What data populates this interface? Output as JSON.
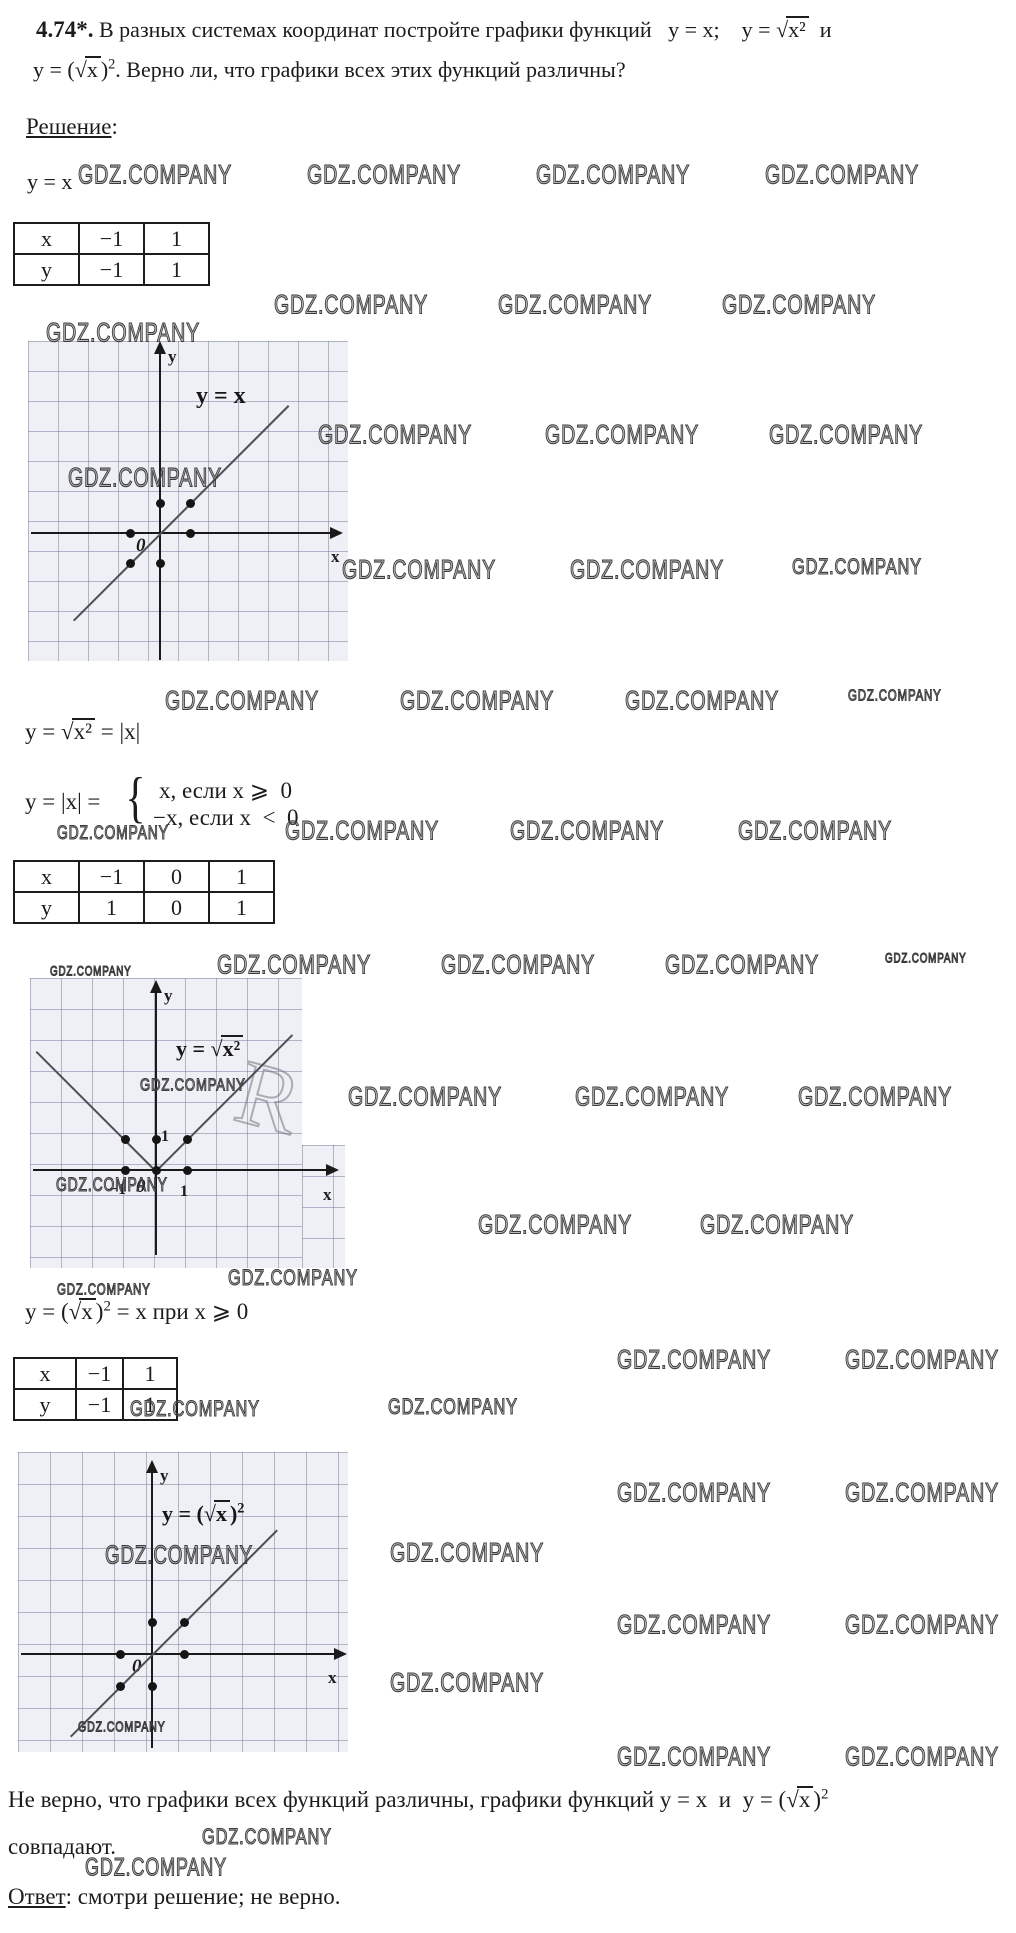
{
  "problem": {
    "number": "4.74*.",
    "line1_a": " В разных системах координат постройте графики функций   y = x;    y = ",
    "line1_sqrt": "√",
    "line1_rad": "x²",
    "line1_b": "  и",
    "line2_a": "y = (",
    "line2_sqrt": "√",
    "line2_rad": "x",
    "line2_b": ")",
    "line2_sup": "2",
    "line2_c": ". Верно ли, что графики всех этих функций различны?"
  },
  "solution_label": "Решение",
  "solution_colon": ":",
  "f1": "y = x",
  "f2": {
    "a": "y = ",
    "sqrt": "√",
    "rad": "x²",
    "b": " = |x|"
  },
  "f3": {
    "a": "y = |x| =",
    "brace": "{",
    "case1": "x, если x ⩾  0",
    "case2": "−x, если x  <  0"
  },
  "f4": {
    "a": "y = (",
    "sqrt": "√",
    "rad": "x",
    "b": ")",
    "sup": "2",
    "c": " = x при x ⩾ 0"
  },
  "conclusion": {
    "a": "Не верно, что графики всех функций различны, графики функций y = x  и  y = (",
    "sqrt": "√",
    "rad": "x",
    "b": ")",
    "sup": "2",
    "line2": "совпадают."
  },
  "answer": {
    "label": "Ответ",
    "text": ": смотри решение; не верно."
  },
  "tables": {
    "t1": {
      "rows": [
        [
          "x",
          "−1",
          "1"
        ],
        [
          "y",
          "−1",
          "1"
        ]
      ]
    },
    "t2": {
      "rows": [
        [
          "x",
          "−1",
          "0",
          "1"
        ],
        [
          "y",
          "1",
          "0",
          "1"
        ]
      ]
    },
    "t3": {
      "rows": [
        [
          "x",
          "−1",
          "1"
        ],
        [
          "y",
          "−1",
          "1"
        ]
      ]
    }
  },
  "watermark_text": "GDZ.COMPANY",
  "ghost_letter": "R",
  "watermarks": [
    {
      "x": 78,
      "y": 160,
      "s": 1
    },
    {
      "x": 307,
      "y": 160,
      "s": 1
    },
    {
      "x": 536,
      "y": 160,
      "s": 1
    },
    {
      "x": 765,
      "y": 160,
      "s": 1
    },
    {
      "x": 274,
      "y": 290,
      "s": 1
    },
    {
      "x": 498,
      "y": 290,
      "s": 1
    },
    {
      "x": 722,
      "y": 290,
      "s": 1
    },
    {
      "x": 46,
      "y": 318,
      "s": 1
    },
    {
      "x": 318,
      "y": 420,
      "s": 1
    },
    {
      "x": 545,
      "y": 420,
      "s": 1
    },
    {
      "x": 769,
      "y": 420,
      "s": 1
    },
    {
      "x": 68,
      "y": 463,
      "s": 1
    },
    {
      "x": 342,
      "y": 555,
      "s": 1
    },
    {
      "x": 570,
      "y": 555,
      "s": 1
    },
    {
      "x": 792,
      "y": 555,
      "s": 0.85
    },
    {
      "x": 165,
      "y": 686,
      "s": 1
    },
    {
      "x": 400,
      "y": 686,
      "s": 1
    },
    {
      "x": 625,
      "y": 686,
      "s": 1
    },
    {
      "x": 848,
      "y": 686,
      "s": 0.6
    },
    {
      "x": 285,
      "y": 816,
      "s": 1
    },
    {
      "x": 510,
      "y": 816,
      "s": 1
    },
    {
      "x": 738,
      "y": 816,
      "s": 1
    },
    {
      "x": 57,
      "y": 822,
      "s": 0.72
    },
    {
      "x": 217,
      "y": 950,
      "s": 1
    },
    {
      "x": 441,
      "y": 950,
      "s": 1
    },
    {
      "x": 665,
      "y": 950,
      "s": 1
    },
    {
      "x": 885,
      "y": 950,
      "s": 0.5
    },
    {
      "x": 50,
      "y": 963,
      "s": 0.5
    },
    {
      "x": 140,
      "y": 1076,
      "s": 0.66
    },
    {
      "x": 348,
      "y": 1082,
      "s": 1
    },
    {
      "x": 575,
      "y": 1082,
      "s": 1
    },
    {
      "x": 798,
      "y": 1082,
      "s": 1
    },
    {
      "x": 56,
      "y": 1174,
      "s": 0.72
    },
    {
      "x": 478,
      "y": 1210,
      "s": 1
    },
    {
      "x": 700,
      "y": 1210,
      "s": 1
    },
    {
      "x": 228,
      "y": 1266,
      "s": 0.85
    },
    {
      "x": 57,
      "y": 1280,
      "s": 0.6
    },
    {
      "x": 617,
      "y": 1345,
      "s": 1
    },
    {
      "x": 845,
      "y": 1345,
      "s": 1
    },
    {
      "x": 130,
      "y": 1397,
      "s": 0.85
    },
    {
      "x": 388,
      "y": 1395,
      "s": 0.85
    },
    {
      "x": 617,
      "y": 1478,
      "s": 1
    },
    {
      "x": 845,
      "y": 1478,
      "s": 1
    },
    {
      "x": 105,
      "y": 1540,
      "s": 0.95
    },
    {
      "x": 390,
      "y": 1538,
      "s": 1
    },
    {
      "x": 617,
      "y": 1610,
      "s": 1
    },
    {
      "x": 845,
      "y": 1610,
      "s": 1
    },
    {
      "x": 390,
      "y": 1668,
      "s": 1
    },
    {
      "x": 78,
      "y": 1718,
      "s": 0.55
    },
    {
      "x": 617,
      "y": 1742,
      "s": 1
    },
    {
      "x": 845,
      "y": 1742,
      "s": 1
    },
    {
      "x": 202,
      "y": 1825,
      "s": 0.85
    },
    {
      "x": 85,
      "y": 1853,
      "s": 0.9
    }
  ],
  "chart_data": [
    {
      "id": "g1",
      "type": "line",
      "title": "y = x",
      "title_parts": {
        "a": "y = x"
      },
      "xlabel": "x",
      "ylabel": "y",
      "origin_label": "0",
      "xlim": [
        -4.4,
        6.1
      ],
      "ylim": [
        -4.3,
        6.4
      ],
      "grid": true,
      "function_points": [
        [
          -1,
          -1
        ],
        [
          0,
          0
        ],
        [
          1,
          1
        ]
      ],
      "marked_points": [
        [
          -1,
          0
        ],
        [
          1,
          0
        ],
        [
          0,
          1
        ],
        [
          1,
          1
        ],
        [
          -1,
          -1
        ],
        [
          0,
          -1
        ]
      ],
      "segments": [
        [
          -2.9,
          -2.9,
          4.27,
          4.27
        ]
      ]
    },
    {
      "id": "g2",
      "type": "line",
      "title": "y = √x² = |x|",
      "title_parts": {
        "a": "y = ",
        "sqrt": "√",
        "rad": "x²"
      },
      "xlabel": "x",
      "ylabel": "y",
      "origin_label": "0",
      "yticks": [
        "1"
      ],
      "xticks": [
        "−1",
        "1"
      ],
      "xlim": [
        -4.1,
        6.1
      ],
      "ylim": [
        -3.2,
        6.2
      ],
      "grid": true,
      "function_points": [
        [
          -1,
          1
        ],
        [
          0,
          0
        ],
        [
          1,
          1
        ]
      ],
      "marked_points": [
        [
          -1,
          1
        ],
        [
          0,
          1
        ],
        [
          1,
          1
        ],
        [
          -1,
          0
        ],
        [
          0,
          0
        ],
        [
          1,
          0
        ]
      ],
      "segments": [
        [
          -3.84,
          3.84,
          0,
          0
        ],
        [
          0,
          0,
          4.39,
          4.39
        ]
      ]
    },
    {
      "id": "g3",
      "type": "line",
      "title": "y = (√x)²",
      "title_parts": {
        "a": "y = (",
        "sqrt": "√",
        "rad": "x",
        "b": ")",
        "sup": "2"
      },
      "xlabel": "x",
      "ylabel": "y",
      "origin_label": "0",
      "xlim": [
        -4.2,
        6.1
      ],
      "ylim": [
        -3.0,
        6.3
      ],
      "grid": true,
      "function_points": [
        [
          -1,
          -1
        ],
        [
          0,
          0
        ],
        [
          1,
          1
        ]
      ],
      "marked_points": [
        [
          -1,
          0
        ],
        [
          1,
          0
        ],
        [
          0,
          1
        ],
        [
          1,
          1
        ],
        [
          -1,
          -1
        ],
        [
          0,
          -1
        ]
      ],
      "segments": [
        [
          -2.55,
          -2.55,
          3.9,
          3.9
        ]
      ]
    }
  ]
}
